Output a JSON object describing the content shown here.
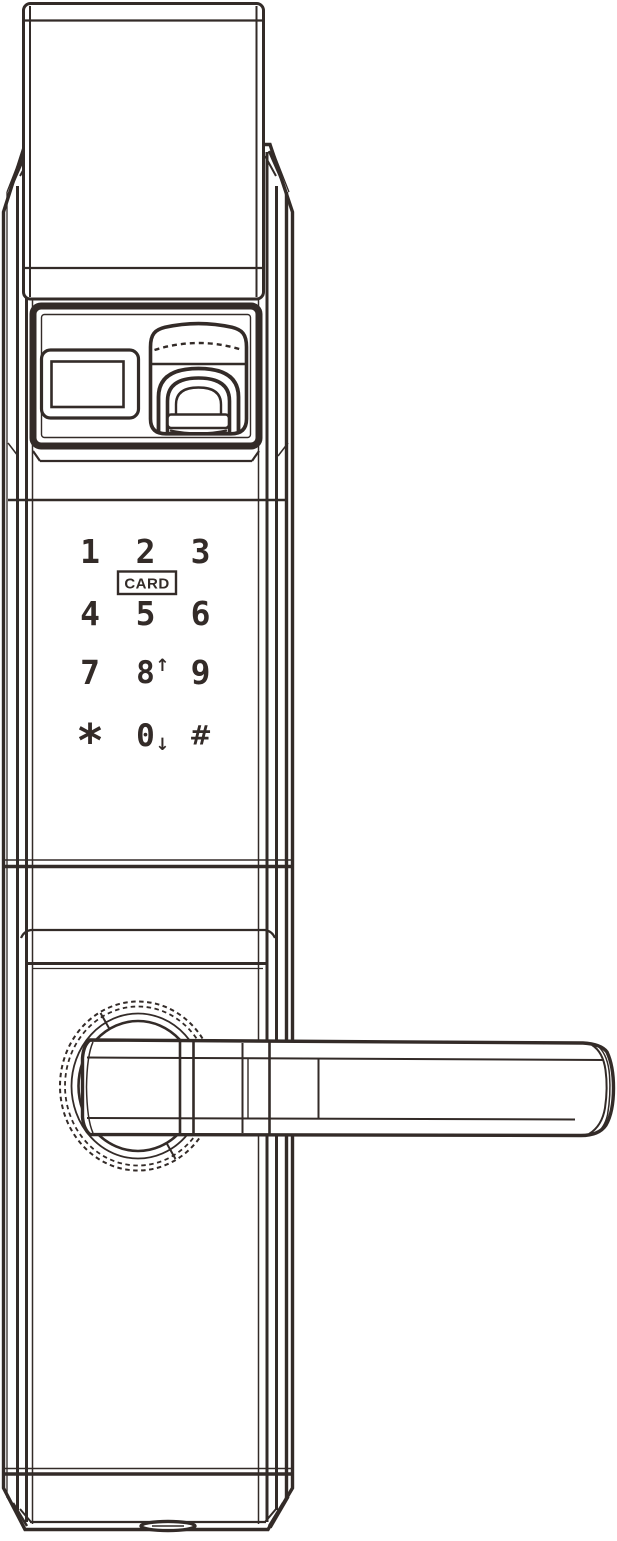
{
  "colors": {
    "line": "#332b28",
    "background": "#ffffff"
  },
  "components": {
    "top_plate": "latch-face-plate",
    "display": "display-window",
    "fingerprint": "fingerprint-reader",
    "card_zone": "card-reader-zone",
    "handle": "lever-handle",
    "rosette": "handle-rosette",
    "bottom_port": "bottom-port-oval"
  },
  "keypad": {
    "card_label": "CARD",
    "keys": [
      {
        "label": "1"
      },
      {
        "label": "2"
      },
      {
        "label": "3"
      },
      {
        "label": "4"
      },
      {
        "label": "5"
      },
      {
        "label": "6"
      },
      {
        "label": "7"
      },
      {
        "label": "8",
        "suffix": "↑"
      },
      {
        "label": "9"
      },
      {
        "label": "*"
      },
      {
        "label": "0",
        "suffix": "↓"
      },
      {
        "label": "#"
      }
    ]
  }
}
